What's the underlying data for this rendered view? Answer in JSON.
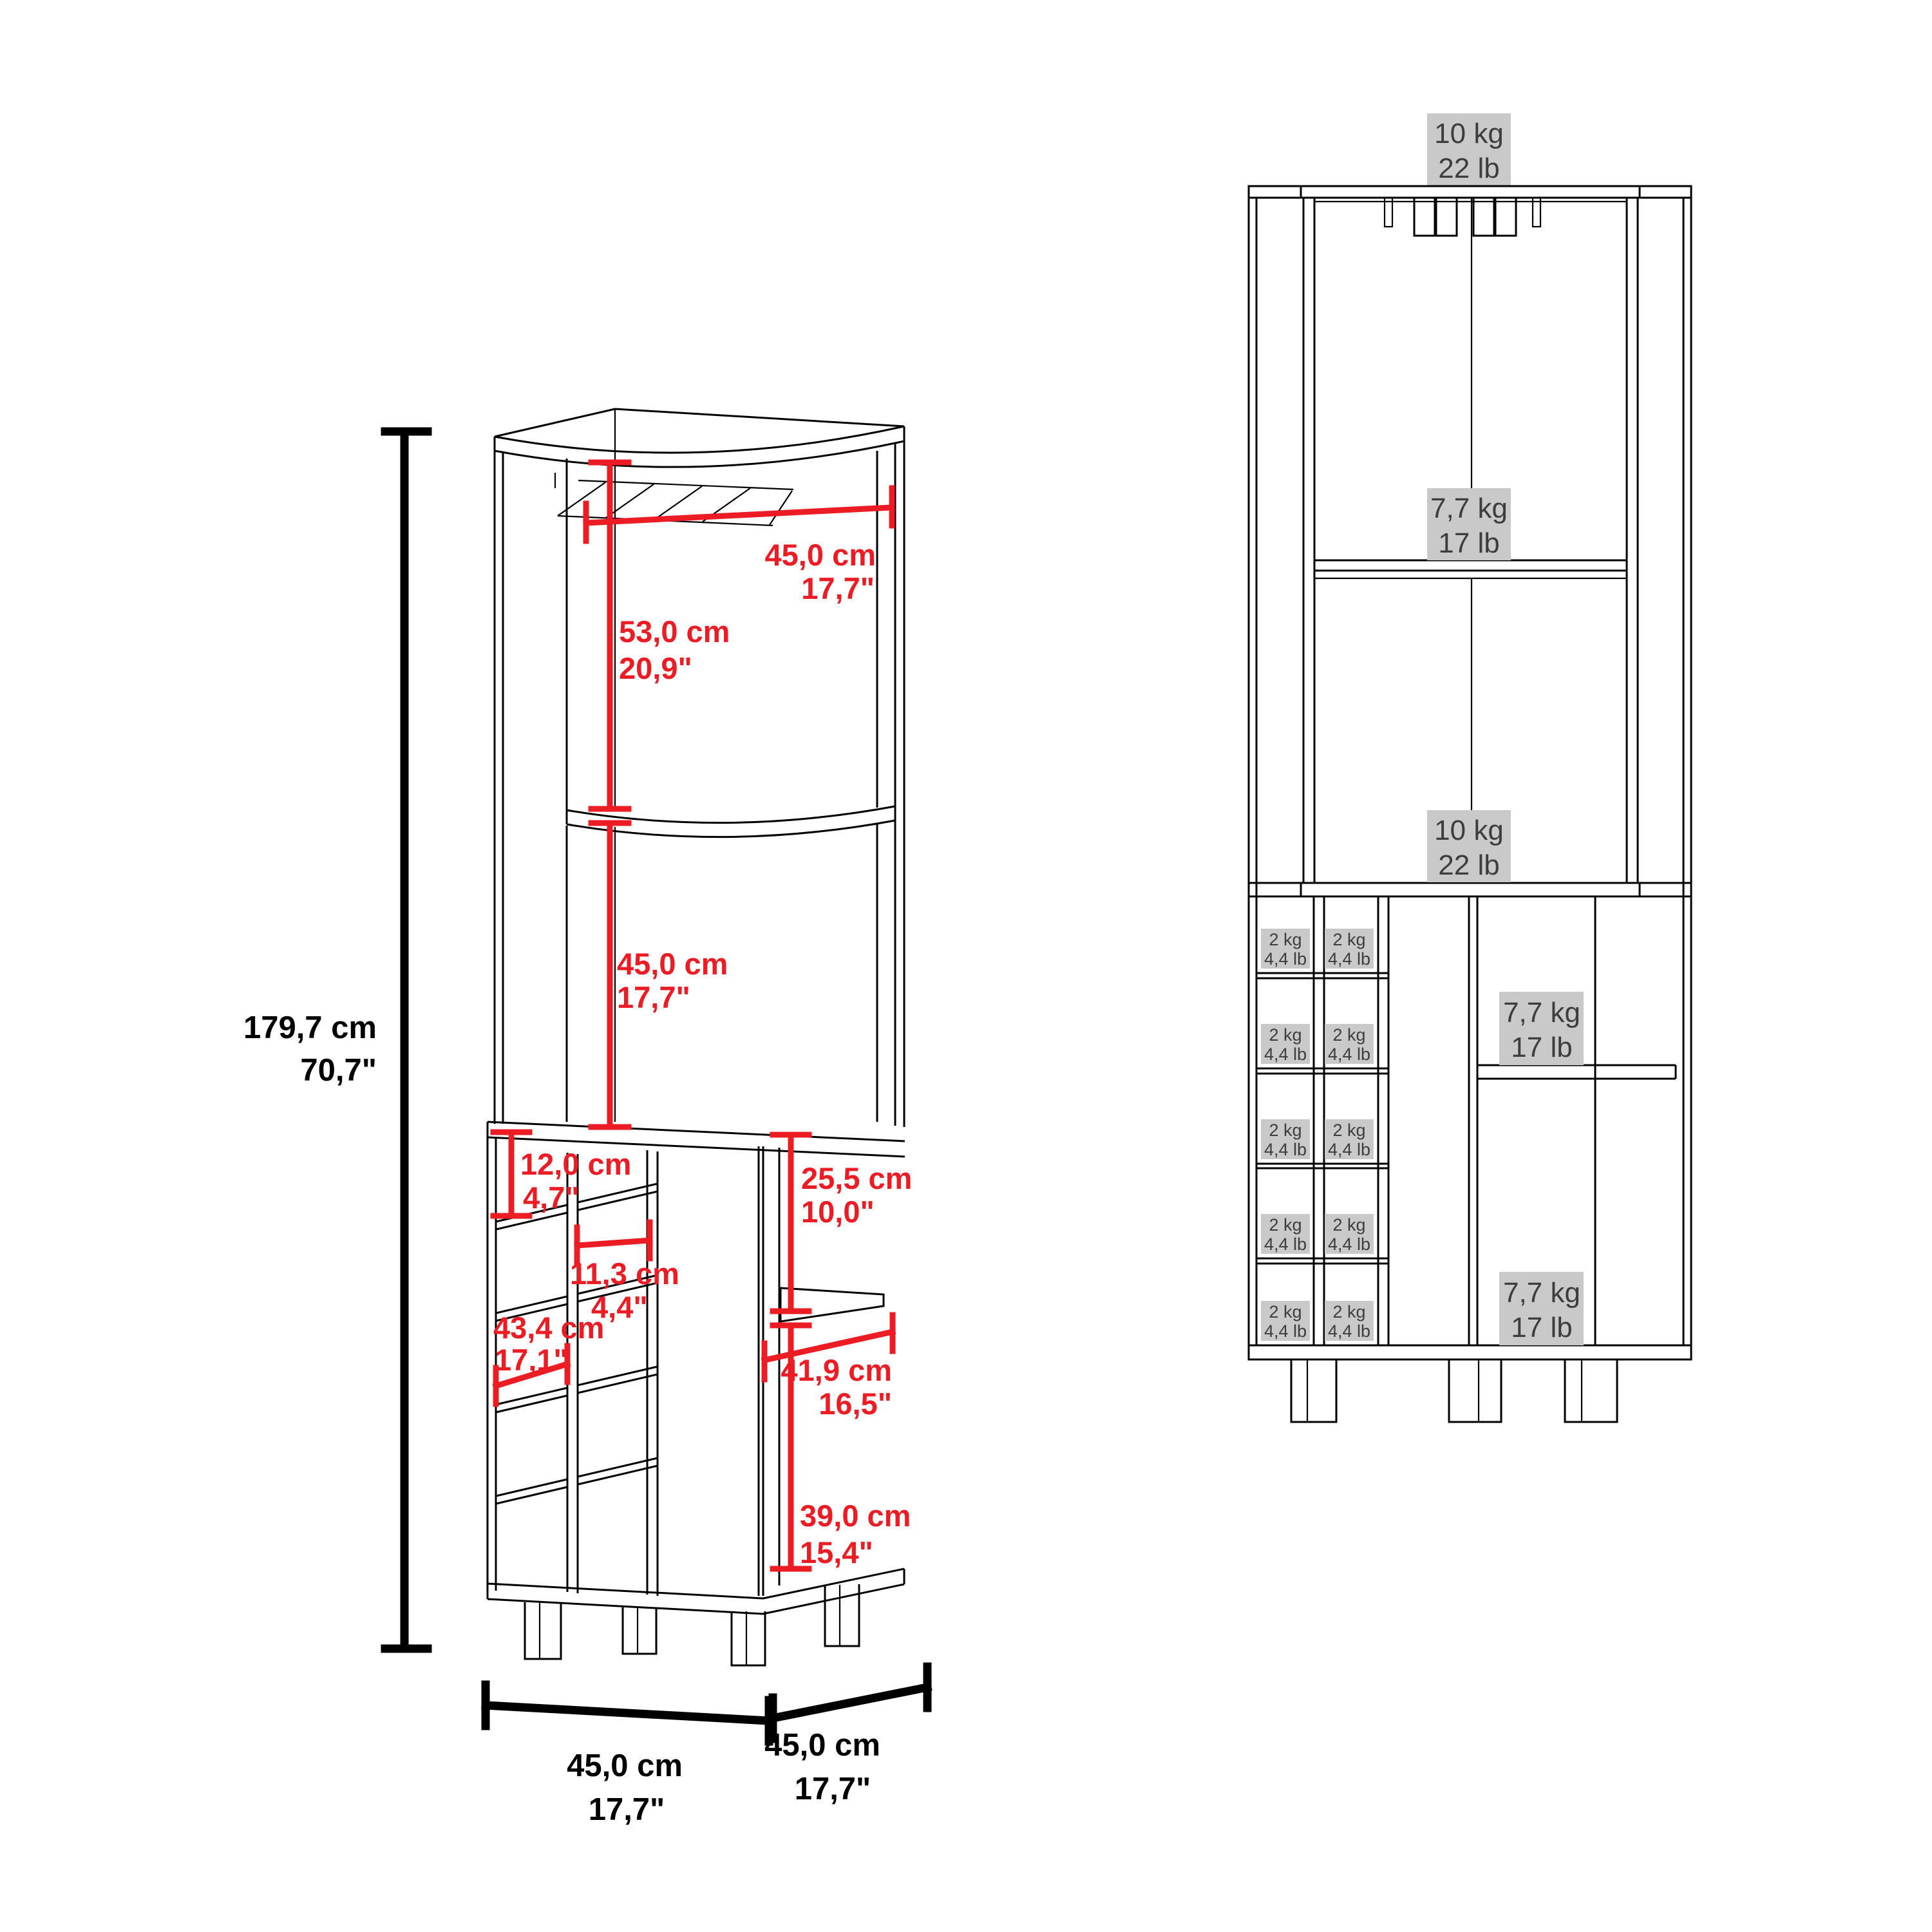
{
  "colors": {
    "accent_red": "#ec1c24",
    "line_black": "#000000",
    "label_bg_gray": "#c9c9c9",
    "label_text_gray": "#3d3d3d"
  },
  "perspective_view": {
    "height_dim": {
      "cm": "179,7 cm",
      "in": "70,7\""
    },
    "top_width_dim": {
      "cm": "45,0 cm",
      "in": "17,7\""
    },
    "upper_section_dim": {
      "cm": "53,0 cm",
      "in": "20,9\""
    },
    "middle_section_dim": {
      "cm": "45,0 cm",
      "in": "17,7\""
    },
    "cubby_offset_dim": {
      "cm": "12,0 cm",
      "in": "4,7\""
    },
    "cubby_width_dim": {
      "cm": "11,3 cm",
      "in": "4,4\""
    },
    "inner_depth_dim": {
      "cm": "43,4 cm",
      "in": "17,1\""
    },
    "side_upper_dim": {
      "cm": "25,5 cm",
      "in": "10,0\""
    },
    "side_shelf_width_dim": {
      "cm": "41,9 cm",
      "in": "16,5\""
    },
    "side_lower_dim": {
      "cm": "39,0 cm",
      "in": "15,4\""
    },
    "base_width_dim": {
      "cm": "45,0 cm",
      "in": "17,7\""
    },
    "base_depth_dim": {
      "cm": "45,0 cm",
      "in": "17,7\""
    }
  },
  "front_view": {
    "top_capacity": {
      "kg": "10 kg",
      "lb": "22 lb"
    },
    "upper_shelf_capacity": {
      "kg": "7,7 kg",
      "lb": "17 lb"
    },
    "upper_bottom_capacity": {
      "kg": "10 kg",
      "lb": "22 lb"
    },
    "side_shelf_capacity": {
      "kg": "7,7 kg",
      "lb": "17 lb"
    },
    "side_bottom_capacity": {
      "kg": "7,7 kg",
      "lb": "17 lb"
    },
    "cubby_capacity": {
      "kg": "2 kg",
      "lb": "4,4 lb"
    }
  }
}
